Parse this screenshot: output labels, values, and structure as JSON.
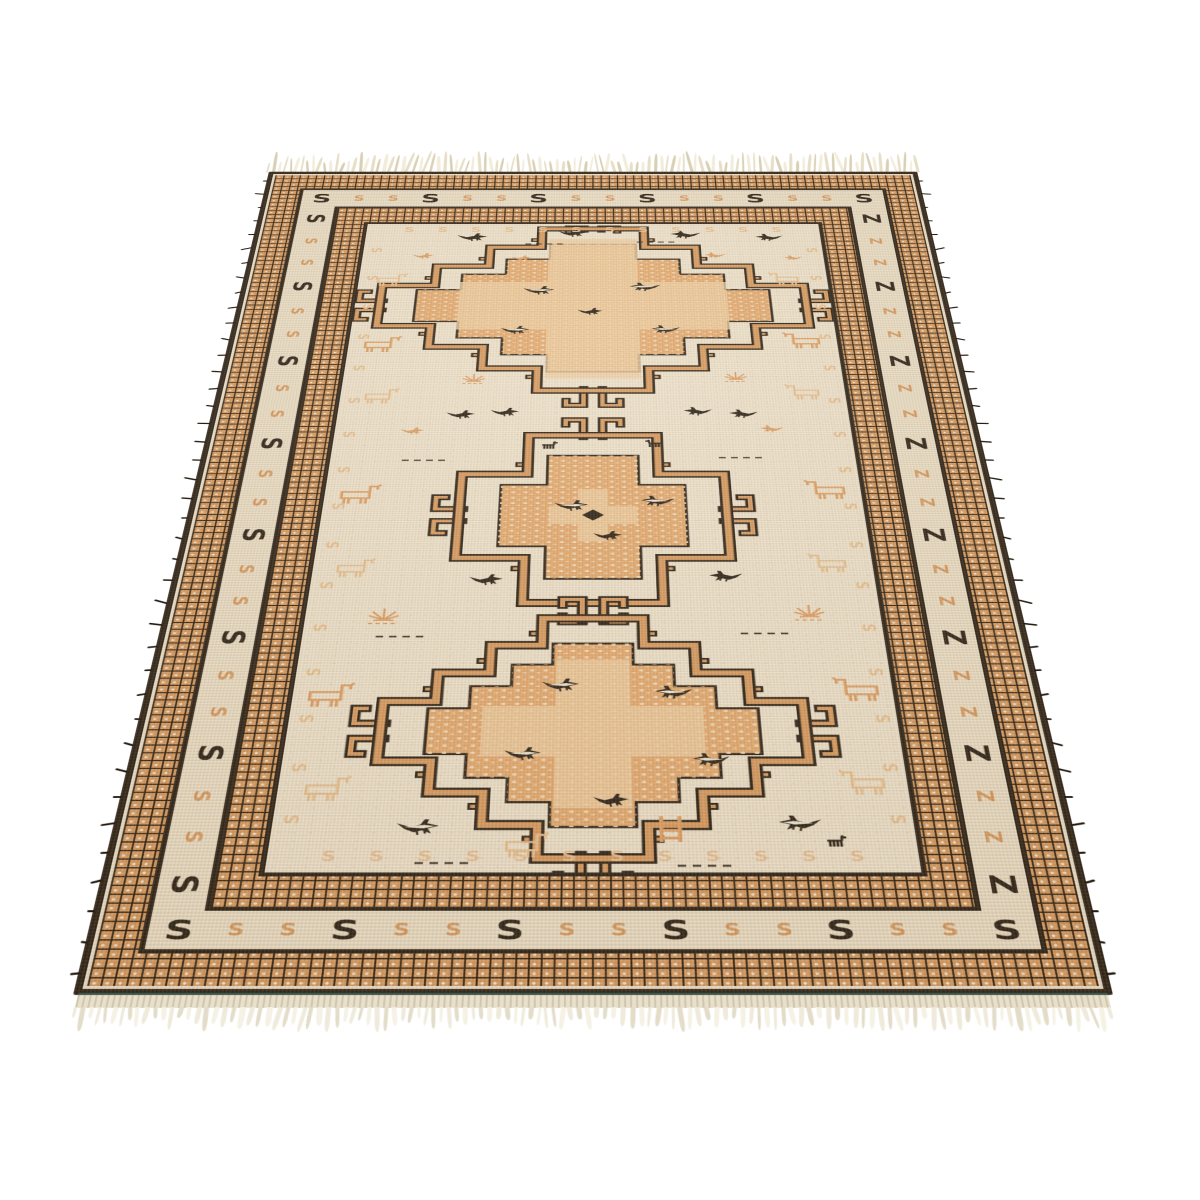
{
  "image_type": "photograph of a handwoven oriental kilim runner rug shown in perspective on a white backdrop",
  "scene": {
    "background": "#ffffff"
  },
  "rug": {
    "colors": {
      "black": "#241b10",
      "orange_band": "#d89a5e",
      "chain_dot": "#f2ead8",
      "cream": "#efe5cf",
      "cream_band": "#ede2c9",
      "field": "#f1e7d1",
      "medallion_orange": "#e5aa6e",
      "medallion_light": "#f0cfa3",
      "motif_orange": "#df9f62",
      "motif_light": "#e9c291",
      "animal_white": "#f3ecda",
      "teal_binding": "#3d564d",
      "selvedge": "#e8e0ca",
      "fringe_shades": [
        "#e7dec6",
        "#d9cfb2",
        "#f2ecda"
      ],
      "bottom_fringe_shades": [
        "#efeadb",
        "#e2dcc8",
        "#f5f1e4"
      ]
    },
    "border": {
      "s_band": {
        "top": {
          "glyph": "S",
          "count": 16
        },
        "bottom": {
          "glyph": "S",
          "count": 16
        },
        "left": {
          "glyph": "S",
          "count": 22
        },
        "right": {
          "glyph": "Z",
          "count": 22
        },
        "big_every": 3
      },
      "field_margin": {
        "glyph": "S",
        "top_count": 12,
        "bottom_count": 12,
        "side_count": 16
      }
    },
    "field": {
      "medallions": [
        {
          "name": "top",
          "cx": 348,
          "cy": 243,
          "hw": 312,
          "hh": 228,
          "steps": 4,
          "center_dot": false
        },
        {
          "name": "middle",
          "cx": 348,
          "cy": 763,
          "hw": 172,
          "hh": 182,
          "steps": 2,
          "center_dot": true
        },
        {
          "name": "bottom",
          "cx": 348,
          "cy": 1180,
          "hw": 242,
          "hh": 205,
          "steps": 4,
          "center_dot": false
        }
      ],
      "animals": [
        {
          "t": "bird",
          "c": "black",
          "x": 140,
          "y": 26,
          "s": 1,
          "f": 1
        },
        {
          "t": "bird",
          "c": "black",
          "x": 295,
          "y": 14,
          "s": 0.95,
          "f": 1
        },
        {
          "t": "bird",
          "c": "black",
          "x": 465,
          "y": 18,
          "s": 1,
          "f": -1
        },
        {
          "t": "bird",
          "c": "black",
          "x": 595,
          "y": 28,
          "s": 0.9,
          "f": -1
        },
        {
          "t": "bird",
          "c": "orange",
          "x": 75,
          "y": 88,
          "s": 0.7,
          "f": 1
        },
        {
          "t": "bird",
          "c": "orange",
          "x": 225,
          "y": 95,
          "s": 0.65,
          "f": 1
        },
        {
          "t": "bird",
          "c": "orange",
          "x": 515,
          "y": 86,
          "s": 0.7,
          "f": -1
        },
        {
          "t": "bird",
          "c": "orange",
          "x": 635,
          "y": 95,
          "s": 0.6,
          "f": -1
        },
        {
          "t": "dash",
          "c": "black",
          "x": 245,
          "y": 58,
          "s": 1,
          "f": 1
        },
        {
          "t": "dash",
          "c": "black",
          "x": 415,
          "y": 52,
          "s": 1,
          "f": 1
        },
        {
          "t": "horse",
          "c": "light",
          "x": 22,
          "y": 148,
          "s": 0.85,
          "f": 1
        },
        {
          "t": "horse",
          "c": "light",
          "x": 608,
          "y": 145,
          "s": 0.85,
          "f": -1
        },
        {
          "t": "bird",
          "c": "blackwhite",
          "x": 245,
          "y": 185,
          "s": 1,
          "f": 1
        },
        {
          "t": "bird",
          "c": "blackwhite",
          "x": 400,
          "y": 175,
          "s": 1,
          "f": -1
        },
        {
          "t": "bird",
          "c": "black",
          "x": 325,
          "y": 248,
          "s": 0.8,
          "f": 1
        },
        {
          "t": "bird",
          "c": "blackwhite",
          "x": 215,
          "y": 298,
          "s": 0.9,
          "f": 1
        },
        {
          "t": "bird",
          "c": "blackwhite",
          "x": 430,
          "y": 296,
          "s": 0.9,
          "f": -1
        },
        {
          "t": "horse",
          "c": "orange",
          "x": 16,
          "y": 325,
          "s": 1,
          "f": 1
        },
        {
          "t": "horse",
          "c": "orange",
          "x": 618,
          "y": 315,
          "s": 1,
          "f": -1
        },
        {
          "t": "plant",
          "c": "orange",
          "x": 165,
          "y": 425,
          "s": 0.85,
          "f": 1
        },
        {
          "t": "plant",
          "c": "orange",
          "x": 530,
          "y": 420,
          "s": 0.85,
          "f": 1
        },
        {
          "t": "horse",
          "c": "light",
          "x": 28,
          "y": 462,
          "s": 0.9,
          "f": 1
        },
        {
          "t": "horse",
          "c": "light",
          "x": 612,
          "y": 452,
          "s": 0.9,
          "f": -1
        },
        {
          "t": "bird",
          "c": "black",
          "x": 148,
          "y": 518,
          "s": 0.85,
          "f": 1
        },
        {
          "t": "bird",
          "c": "black",
          "x": 208,
          "y": 512,
          "s": 0.85,
          "f": 1
        },
        {
          "t": "bird",
          "c": "black",
          "x": 470,
          "y": 510,
          "s": 0.85,
          "f": -1
        },
        {
          "t": "bird",
          "c": "black",
          "x": 532,
          "y": 516,
          "s": 0.85,
          "f": -1
        },
        {
          "t": "bird",
          "c": "orange",
          "x": 88,
          "y": 560,
          "s": 0.7,
          "f": 1
        },
        {
          "t": "bird",
          "c": "orange",
          "x": 572,
          "y": 555,
          "s": 0.7,
          "f": -1
        },
        {
          "t": "goat",
          "c": "black",
          "x": 278,
          "y": 594,
          "s": 1,
          "f": 1
        },
        {
          "t": "goat",
          "c": "black",
          "x": 415,
          "y": 590,
          "s": 1,
          "f": -1
        },
        {
          "t": "dash",
          "c": "black",
          "x": 95,
          "y": 636,
          "s": 1,
          "f": 1
        },
        {
          "t": "dash",
          "c": "black",
          "x": 515,
          "y": 630,
          "s": 1,
          "f": 1
        },
        {
          "t": "horse",
          "c": "orange",
          "x": 14,
          "y": 692,
          "s": 1,
          "f": 1
        },
        {
          "t": "horse",
          "c": "orange",
          "x": 622,
          "y": 682,
          "s": 1,
          "f": -1
        },
        {
          "t": "bird",
          "c": "blackwhite",
          "x": 298,
          "y": 728,
          "s": 0.95,
          "f": 1
        },
        {
          "t": "bird",
          "c": "blackwhite",
          "x": 408,
          "y": 718,
          "s": 0.95,
          "f": -1
        },
        {
          "t": "bird",
          "c": "black",
          "x": 348,
          "y": 795,
          "s": 0.8,
          "f": 1
        },
        {
          "t": "horse",
          "c": "light",
          "x": 24,
          "y": 852,
          "s": 0.9,
          "f": 1
        },
        {
          "t": "horse",
          "c": "light",
          "x": 615,
          "y": 842,
          "s": 0.9,
          "f": -1
        },
        {
          "t": "bird",
          "c": "black",
          "x": 195,
          "y": 885,
          "s": 0.9,
          "f": 1
        },
        {
          "t": "bird",
          "c": "black",
          "x": 490,
          "y": 878,
          "s": 0.9,
          "f": -1
        },
        {
          "t": "plant",
          "c": "orange",
          "x": 75,
          "y": 952,
          "s": 1,
          "f": 1
        },
        {
          "t": "plant",
          "c": "orange",
          "x": 590,
          "y": 945,
          "s": 1,
          "f": 1
        },
        {
          "t": "dash",
          "c": "black",
          "x": 88,
          "y": 1006,
          "s": 1,
          "f": 1
        },
        {
          "t": "dash",
          "c": "black",
          "x": 525,
          "y": 1000,
          "s": 1,
          "f": 1
        },
        {
          "t": "horse",
          "c": "orange",
          "x": 12,
          "y": 1092,
          "s": 1,
          "f": 1
        },
        {
          "t": "horse",
          "c": "orange",
          "x": 626,
          "y": 1082,
          "s": 1,
          "f": -1
        },
        {
          "t": "bird",
          "c": "blackwhite",
          "x": 288,
          "y": 1085,
          "s": 0.95,
          "f": 1
        },
        {
          "t": "bird",
          "c": "blackwhite",
          "x": 418,
          "y": 1098,
          "s": 0.95,
          "f": -1
        },
        {
          "t": "bird",
          "c": "blackwhite",
          "x": 248,
          "y": 1205,
          "s": 0.9,
          "f": 1
        },
        {
          "t": "bird",
          "c": "blackwhite",
          "x": 458,
          "y": 1215,
          "s": 0.9,
          "f": -1
        },
        {
          "t": "bird",
          "c": "black",
          "x": 348,
          "y": 1282,
          "s": 0.85,
          "f": 1
        },
        {
          "t": "horse",
          "c": "light",
          "x": 24,
          "y": 1252,
          "s": 0.95,
          "f": 1
        },
        {
          "t": "horse",
          "c": "light",
          "x": 620,
          "y": 1242,
          "s": 0.95,
          "f": -1
        },
        {
          "t": "bird",
          "c": "blackwhite",
          "x": 135,
          "y": 1322,
          "s": 1,
          "f": 1
        },
        {
          "t": "bird",
          "c": "blackwhite",
          "x": 548,
          "y": 1316,
          "s": 1,
          "f": -1
        },
        {
          "t": "ladder",
          "c": "orange",
          "x": 418,
          "y": 1318,
          "s": 1,
          "f": 1
        },
        {
          "t": "horse",
          "c": "light",
          "x": 248,
          "y": 1342,
          "s": 0.9,
          "f": 1
        },
        {
          "t": "goat",
          "c": "black",
          "x": 598,
          "y": 1348,
          "s": 1,
          "f": 1
        },
        {
          "t": "dash",
          "c": "black",
          "x": 158,
          "y": 1388,
          "s": 1,
          "f": 1
        },
        {
          "t": "dash",
          "c": "black",
          "x": 438,
          "y": 1392,
          "s": 1,
          "f": 1
        }
      ]
    },
    "fringes": {
      "top_count": 112,
      "bottom_count": 124,
      "side_fray_count": 40
    }
  }
}
